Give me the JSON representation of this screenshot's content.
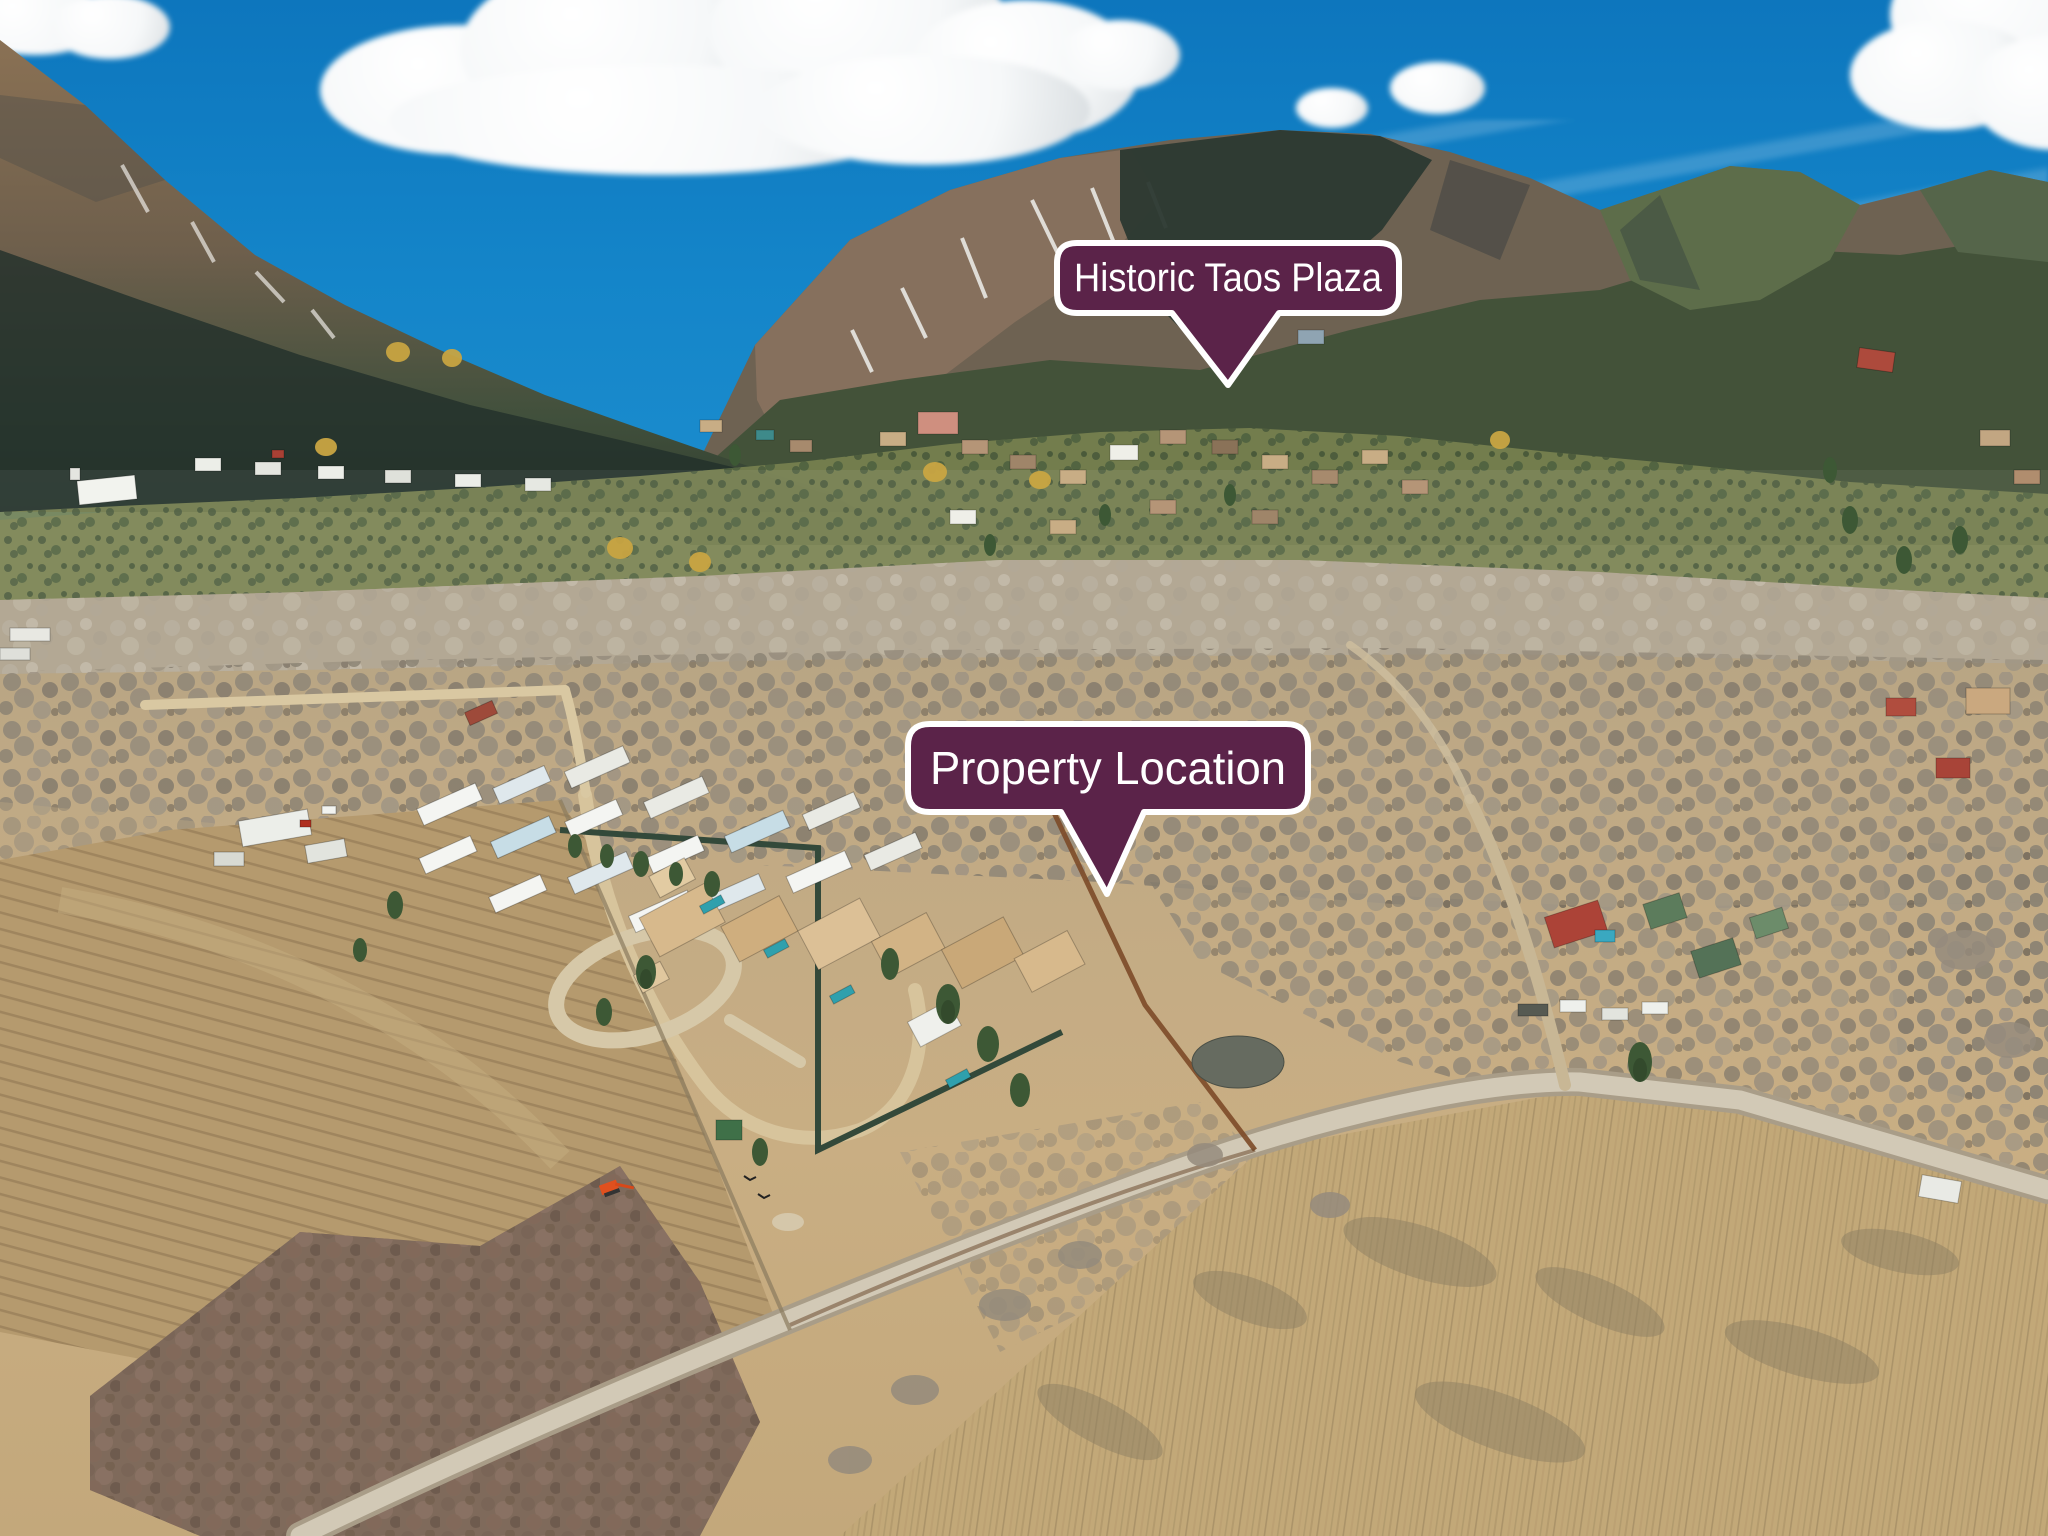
{
  "callouts": {
    "plaza": {
      "label": "Historic Taos Plaza"
    },
    "property": {
      "label": "Property Location"
    }
  },
  "colors": {
    "callout_fill": "#5b2349",
    "callout_border": "#ffffff",
    "callout_text": "#ffffff",
    "sky_top": "#0d76bd",
    "sky_horizon": "#8cc6de",
    "valley_tan": "#bfa985",
    "mountain_forest": "#435239",
    "road_gray": "#d2c9b6"
  }
}
